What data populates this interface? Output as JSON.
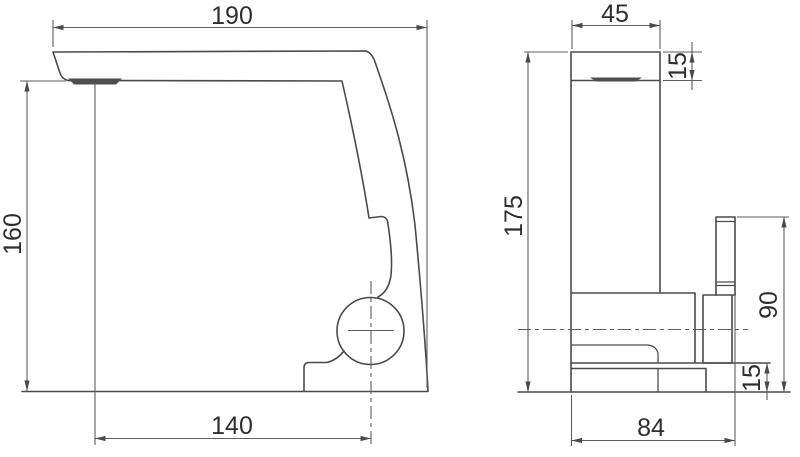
{
  "drawing": {
    "background_color": "#ffffff",
    "line_color": "#4a4a4a",
    "dim_line_color": "#5e5e5e",
    "text_color": "#2e2e2e",
    "views": {
      "side": {
        "title": "side-profile-view",
        "dims": {
          "spout_reach_top": "190",
          "height_to_spout": "160",
          "outlet_to_axis": "140"
        }
      },
      "front": {
        "title": "front-view",
        "dims": {
          "body_width": "45",
          "spout_section_height": "15",
          "overall_height": "175",
          "handle_top_height": "90",
          "base_height": "15",
          "overall_depth": "84"
        }
      }
    }
  }
}
